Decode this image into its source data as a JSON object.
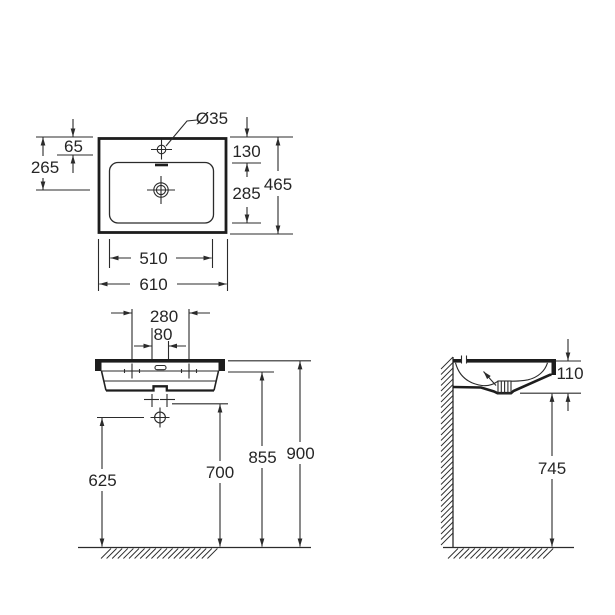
{
  "colors": {
    "ink": "#2b2b2b",
    "outline": "#1d1d1d",
    "paper": "#ffffff"
  },
  "dimensions": {
    "plan": {
      "tap_hole_diameter": "Ø35",
      "tap_hole_offset": "65",
      "drain_center_offset": "265",
      "bowl_back_offset": "130",
      "bowl_depth": "285",
      "overall_depth": "465",
      "bowl_width": "510",
      "overall_width": "610"
    },
    "front": {
      "fixing_hole_spacing": "280",
      "drain_slot_width": "80",
      "trap_outlet_height": "625",
      "basin_underside_height": "700",
      "rim_underside_height": "855",
      "overall_height": "900"
    },
    "side": {
      "basin_section_height": "110",
      "underside_clearance_height": "745"
    }
  }
}
